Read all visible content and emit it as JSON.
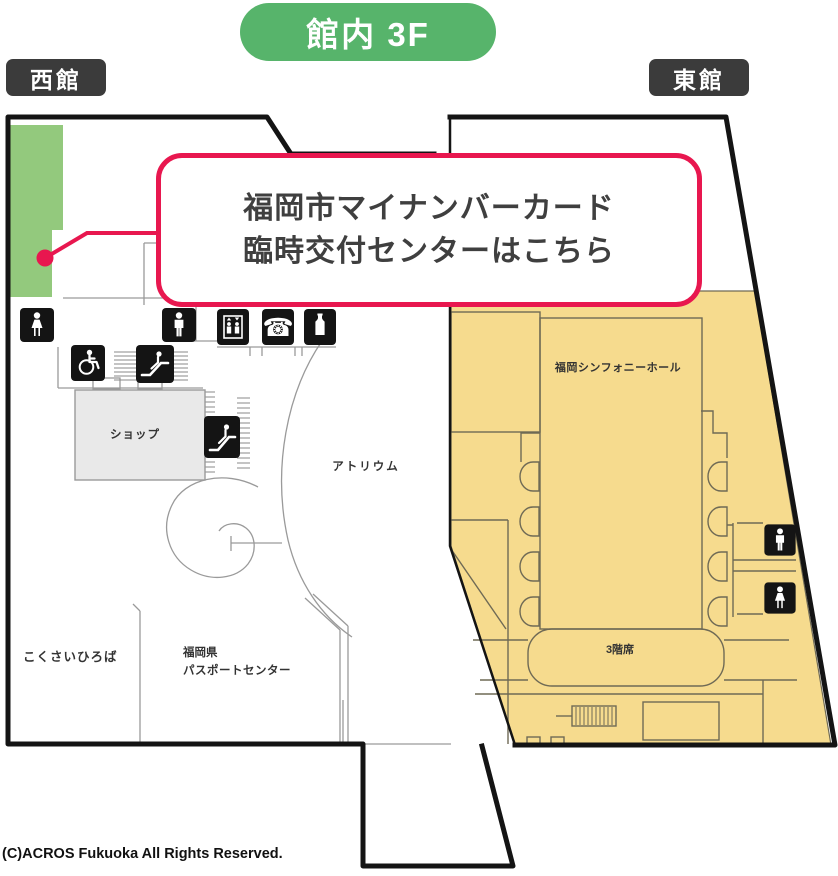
{
  "header": {
    "floor_badge": "館内 3F"
  },
  "wings": {
    "west": "西館",
    "east": "東館"
  },
  "callout": {
    "line1": "福岡市マイナンバーカード",
    "line2": "臨時交付センターはこちら"
  },
  "map": {
    "areas": {
      "shop": "ショップ",
      "atrium": "アトリウム",
      "symphony_hall": "福岡シンフォニーホール",
      "third_floor_seats": "3階席",
      "kokusai_hiroba": "こくさいひろば",
      "passport_center_line1": "福岡県",
      "passport_center_line2": "パスポートセンター"
    },
    "icons": [
      "female-toilet",
      "male-toilet",
      "elevator",
      "telephone",
      "vending-machine",
      "wheelchair",
      "escalator",
      "escalator",
      "male-toilet",
      "female-toilet"
    ],
    "glyphs": {
      "phone": "☎"
    },
    "colors": {
      "badge_green": "#57b46b",
      "highlight_green": "#93c97d",
      "hall_yellow": "#f6db8e",
      "accent_red": "#e8174f",
      "label_dark": "#3b3b3b",
      "outline_black": "#141414"
    }
  },
  "footer": {
    "copyright": "(C)ACROS Fukuoka All Rights Reserved."
  }
}
